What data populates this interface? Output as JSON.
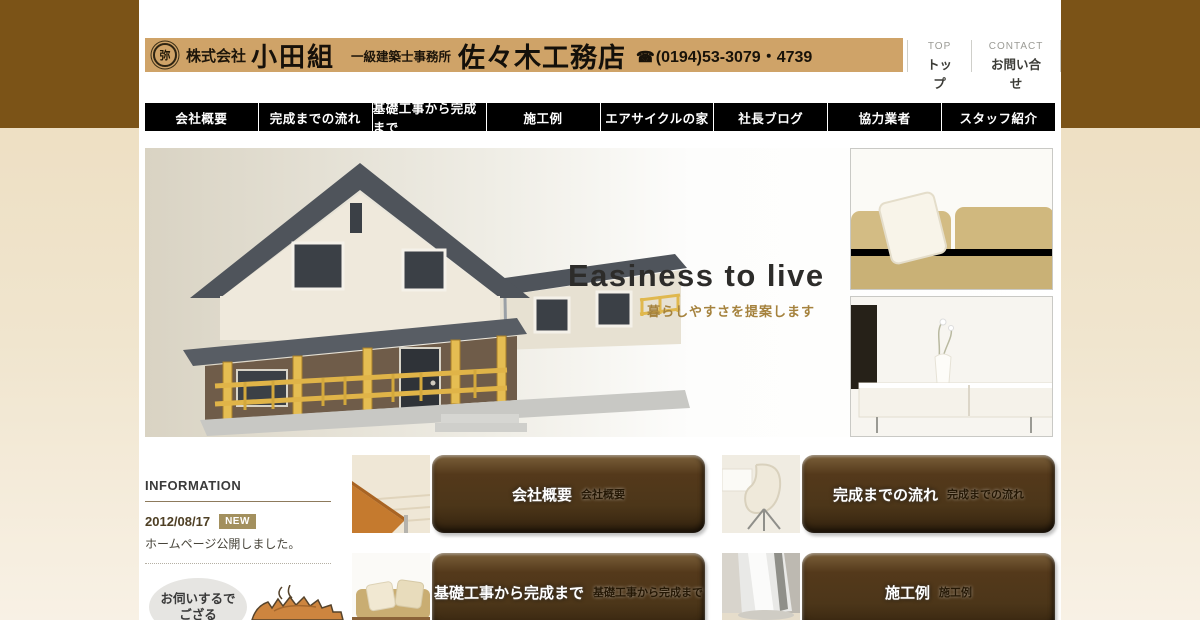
{
  "header": {
    "seal_char": "弥",
    "company_prefix": "株式会社",
    "company_name": "小田組",
    "office_type": "一級建築士事務所",
    "brand": "佐々木工務店",
    "phone_icon": "☎",
    "phone": "(0194)53-3079・4739",
    "utility": [
      {
        "en": "TOP",
        "ja": "トップ"
      },
      {
        "en": "CONTACT",
        "ja": "お問い合せ"
      }
    ]
  },
  "nav": {
    "items": [
      {
        "label": "会社概要"
      },
      {
        "label": "完成までの流れ"
      },
      {
        "label": "基礎工事から完成まで"
      },
      {
        "label": "施工例"
      },
      {
        "label": "エアサイクルの家"
      },
      {
        "label": "社長ブログ"
      },
      {
        "label": "協力業者"
      },
      {
        "label": "スタッフ紹介"
      }
    ]
  },
  "hero": {
    "title": "Easiness to live",
    "subtitle": "暮らしやすさを提案します"
  },
  "info": {
    "heading": "INFORMATION",
    "date": "2012/08/17",
    "badge": "NEW",
    "news": "ホームページ公開しました。"
  },
  "banners": [
    {
      "label": "会社概要",
      "shadow": "会社概要"
    },
    {
      "label": "完成までの流れ",
      "shadow": "完成までの流れ"
    },
    {
      "label": "基礎工事から完成まで",
      "shadow": "基礎工事から完成まで"
    },
    {
      "label": "施工例",
      "shadow": "施工例"
    }
  ],
  "mascot": {
    "bubble_line1": "お伺いするで",
    "bubble_line2": "ござる"
  },
  "colors": {
    "side_brown": "#7B5317",
    "logo_strip_tan": "#CFA368",
    "nav_black": "#000000",
    "accent_gold": "#A5823D",
    "button_brown": "#4C3619",
    "badge_gold": "#A3905E"
  }
}
